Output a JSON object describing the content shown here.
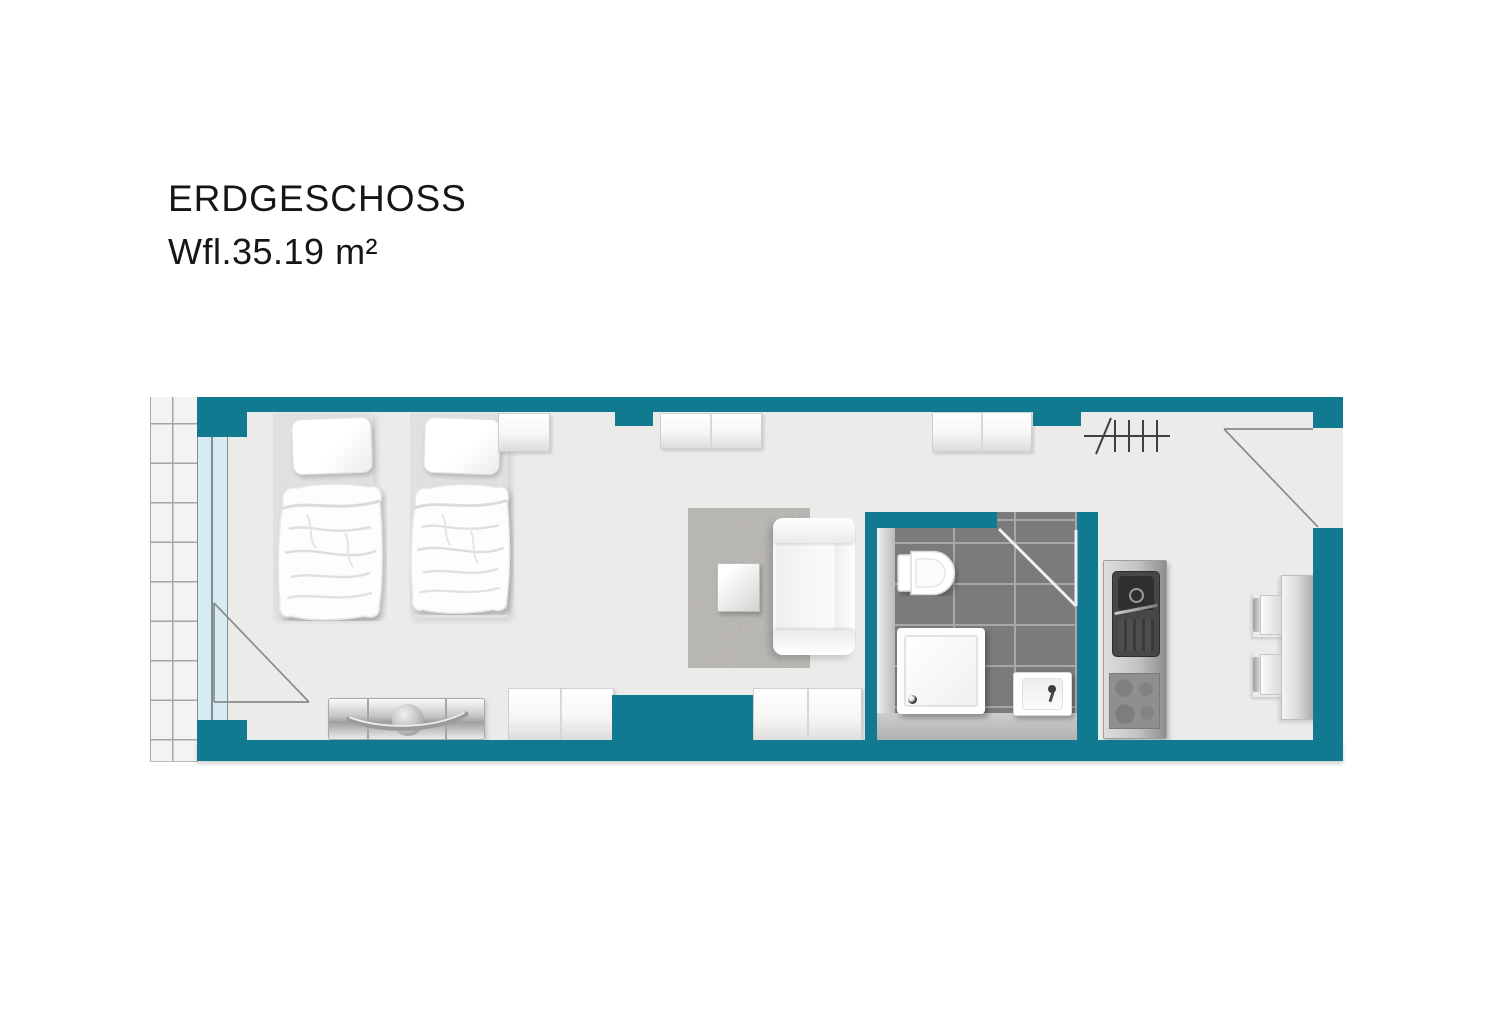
{
  "header": {
    "floor_label": "ERDGESCHOSS",
    "area_label": "Wfl.35.19 m²"
  },
  "palette": {
    "wall_teal": "#117a90",
    "room_floor": "#ebebe9",
    "terrace_tile": "#f3f3f1",
    "grid_line": "#a6a6a4",
    "glazing_blue": "#d6ecf2",
    "bath_tile": "#7b7b7b",
    "bath_grout": "#a8a8a8",
    "swing_line": "#8a8a8a",
    "bath_door_line": "#f1f1ef",
    "metal_light": "#dededc",
    "metal_dark": "#8e8e8c",
    "sink_dark": "#474747",
    "text": "#161616"
  },
  "icons": {
    "window_door": "triangle-swing-lines",
    "entry_door": "triangle-swing-lines",
    "bathroom_door": "white-swing-lines",
    "radiator": "crossed-tick-symbol"
  },
  "furniture": [
    "single-bed-left",
    "single-bed-right",
    "pillow",
    "duvet",
    "wall-cabinet-1",
    "wall-cabinet-2",
    "wall-cabinet-3",
    "low-cabinet-1",
    "low-cabinet-2",
    "sideboard-dresser",
    "rug",
    "coffee-table",
    "sofa",
    "toilet",
    "shower-tray",
    "washbasin",
    "kitchenette-sink",
    "cooktop",
    "dining-table",
    "chair-1",
    "chair-2"
  ]
}
